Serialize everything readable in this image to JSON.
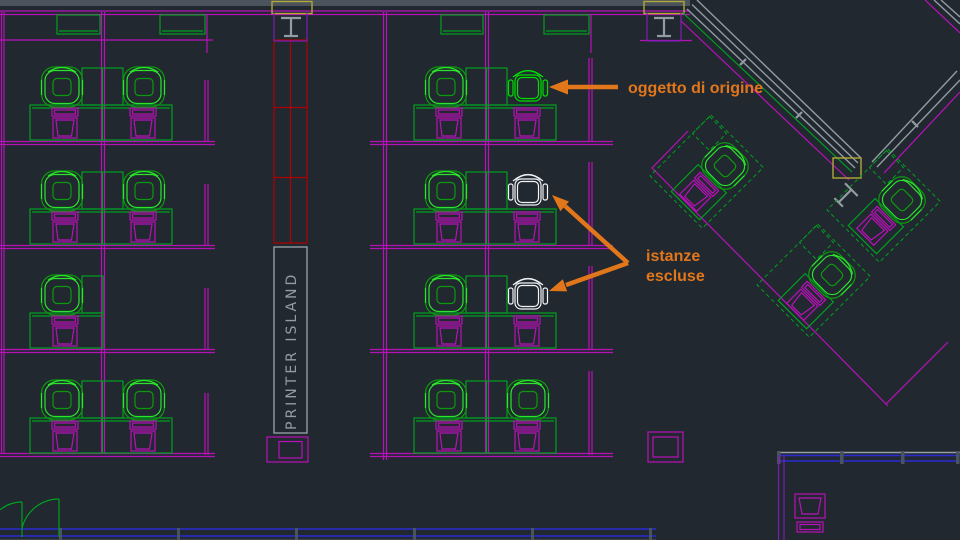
{
  "drawing": {
    "printer_island_label": "PRINTER ISLAND",
    "annotation_origin": "oggetto di origine",
    "annotation_excluded_line1": "istanze",
    "annotation_excluded_line2": "escluse"
  },
  "colors": {
    "background": "#212830",
    "magenta": "#b911b9",
    "purple": "#7a1fb0",
    "green": "#00a01e",
    "chair_highlight_green": "#2ae52a",
    "chair_highlight_dark": "#0c9a0c",
    "chair_origin_green": "#00dd00",
    "chair_excluded_white": "#f2f5f5",
    "teal": "#1d7f93",
    "red": "#b00000",
    "gray": "#949ca3",
    "gray_dark": "#4b535c",
    "yellow": "#b2a737",
    "blue": "#2b2bd5",
    "orange": "#e2761b"
  },
  "chairs": [
    {
      "id": "left-r1-a",
      "x": 62,
      "y": 87,
      "rot": 0,
      "state": "highlighted"
    },
    {
      "id": "left-r1-b",
      "x": 144,
      "y": 87,
      "rot": 0,
      "state": "highlighted"
    },
    {
      "id": "left-r2-a",
      "x": 62,
      "y": 191,
      "rot": 0,
      "state": "highlighted"
    },
    {
      "id": "left-r2-b",
      "x": 144,
      "y": 191,
      "rot": 0,
      "state": "highlighted"
    },
    {
      "id": "left-r3-a",
      "x": 62,
      "y": 295,
      "rot": 0,
      "state": "highlighted"
    },
    {
      "id": "left-r4-a",
      "x": 62,
      "y": 400,
      "rot": 0,
      "state": "highlighted"
    },
    {
      "id": "left-r4-b",
      "x": 144,
      "y": 400,
      "rot": 0,
      "state": "highlighted"
    },
    {
      "id": "mid-r1-a",
      "x": 446,
      "y": 87,
      "rot": 0,
      "state": "highlighted"
    },
    {
      "id": "mid-r1-b",
      "x": 528,
      "y": 87,
      "rot": 0,
      "state": "origin"
    },
    {
      "id": "mid-r2-a",
      "x": 446,
      "y": 191,
      "rot": 0,
      "state": "highlighted"
    },
    {
      "id": "mid-r2-b",
      "x": 528,
      "y": 191,
      "rot": 0,
      "state": "excluded"
    },
    {
      "id": "mid-r3-a",
      "x": 446,
      "y": 295,
      "rot": 0,
      "state": "highlighted"
    },
    {
      "id": "mid-r3-b",
      "x": 528,
      "y": 295,
      "rot": 0,
      "state": "excluded"
    },
    {
      "id": "mid-r4-a",
      "x": 446,
      "y": 400,
      "rot": 0,
      "state": "highlighted"
    },
    {
      "id": "mid-r4-b",
      "x": 528,
      "y": 400,
      "rot": 0,
      "state": "highlighted"
    },
    {
      "id": "diag-a",
      "x": 725,
      "y": 166,
      "rot": 45,
      "state": "highlighted"
    },
    {
      "id": "diag-b",
      "x": 902,
      "y": 200,
      "rot": 45,
      "state": "highlighted"
    },
    {
      "id": "diag-c",
      "x": 832,
      "y": 275,
      "rot": 45,
      "state": "highlighted"
    }
  ],
  "clusters": {
    "blocks": [
      {
        "ox": 0,
        "rows": [
          {
            "y": 58,
            "right": true
          },
          {
            "y": 162,
            "right": true
          },
          {
            "y": 266,
            "right": false
          },
          {
            "y": 371,
            "right": true
          }
        ]
      },
      {
        "ox": 384,
        "rows": [
          {
            "y": 58,
            "right": true
          },
          {
            "y": 162,
            "right": true
          },
          {
            "y": 266,
            "right": true
          },
          {
            "y": 371,
            "right": true
          }
        ]
      }
    ],
    "diagonal_cubicles": [
      {
        "cx": 725,
        "cy": 166
      },
      {
        "cx": 902,
        "cy": 200
      },
      {
        "cx": 832,
        "cy": 275
      }
    ]
  }
}
